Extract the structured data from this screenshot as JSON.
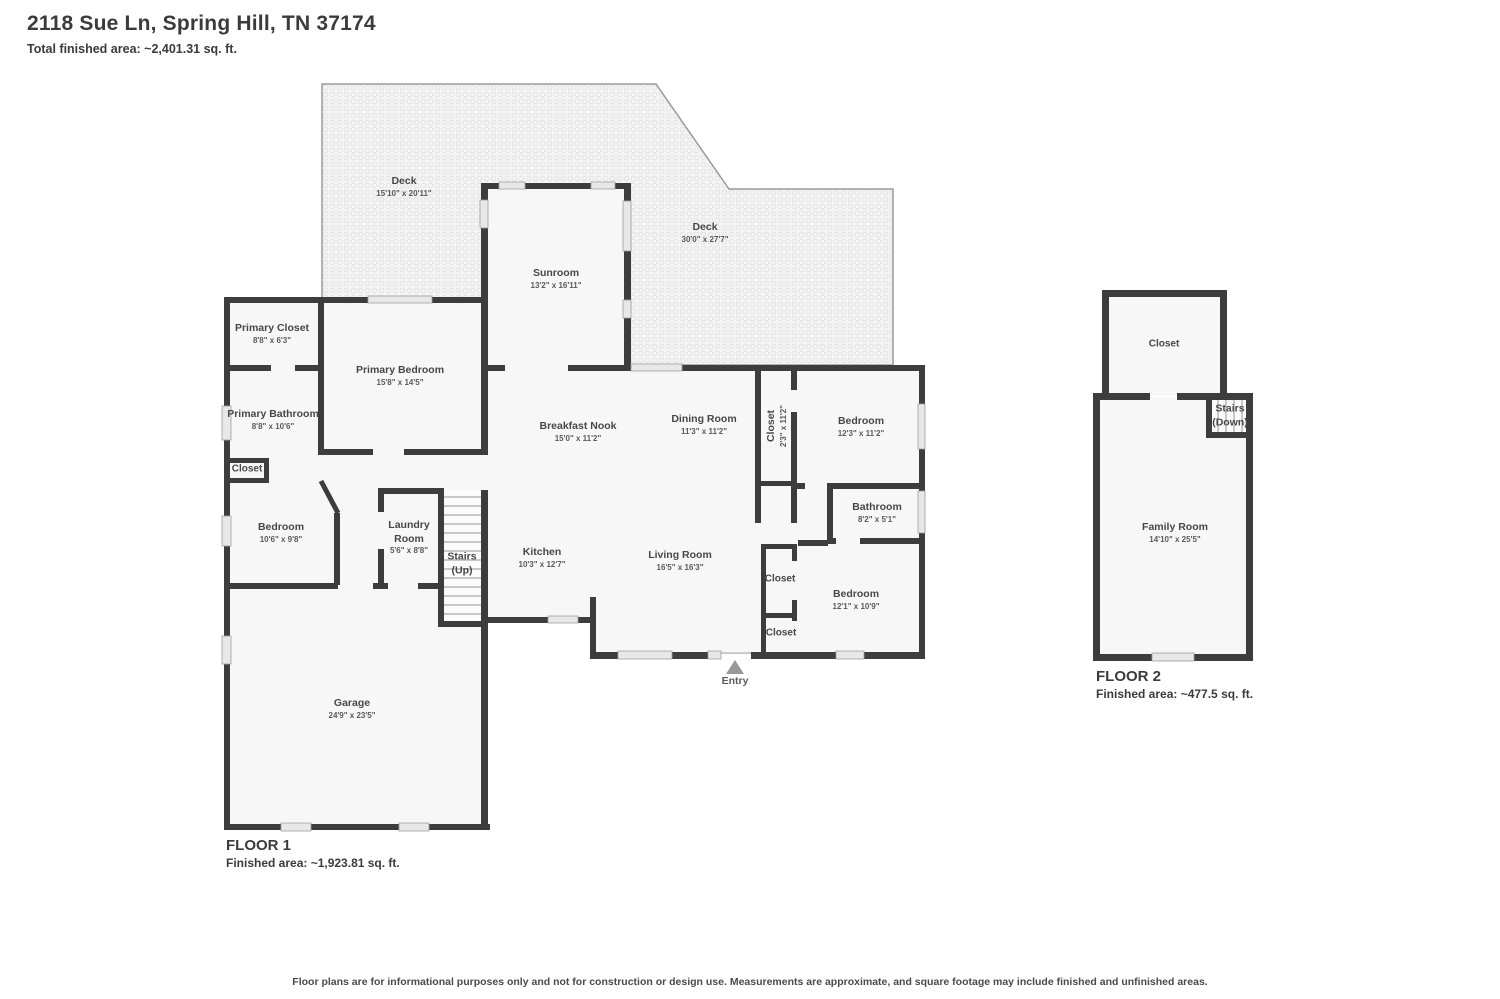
{
  "header": {
    "title": "2118 Sue Ln, Spring Hill, TN 37174",
    "subtitle": "Total finished area: ~2,401.31 sq. ft."
  },
  "floor1": {
    "title": "FLOOR 1",
    "area": "Finished area: ~1,923.81 sq. ft.",
    "rooms": {
      "deck_left": {
        "name": "Deck",
        "dims": "15'10\" x 20'11\""
      },
      "deck_right": {
        "name": "Deck",
        "dims": "30'0\" x 27'7\""
      },
      "sunroom": {
        "name": "Sunroom",
        "dims": "13'2\" x 16'11\""
      },
      "primary_closet": {
        "name": "Primary Closet",
        "dims": "8'8\" x 6'3\""
      },
      "primary_bedroom": {
        "name": "Primary Bedroom",
        "dims": "15'8\" x 14'5\""
      },
      "primary_bathroom": {
        "name": "Primary Bathroom",
        "dims": "8'8\" x 10'6\""
      },
      "closet_a": {
        "name": "Closet"
      },
      "bedroom_left": {
        "name": "Bedroom",
        "dims": "10'6\" x 9'8\""
      },
      "laundry": {
        "name": "Laundry Room",
        "dims": "5'6\" x 8'8\""
      },
      "stairs": {
        "name": "Stairs",
        "dims": "(Up)"
      },
      "kitchen": {
        "name": "Kitchen",
        "dims": "10'3\" x 12'7\""
      },
      "breakfast": {
        "name": "Breakfast Nook",
        "dims": "15'0\" x 11'2\""
      },
      "dining": {
        "name": "Dining Room",
        "dims": "11'3\" x 11'2\""
      },
      "closet_tall": {
        "name": "Closet",
        "dims": "2'3\" x 11'2\""
      },
      "bedroom_ne": {
        "name": "Bedroom",
        "dims": "12'3\" x 11'2\""
      },
      "bathroom": {
        "name": "Bathroom",
        "dims": "8'2\" x 5'1\""
      },
      "living": {
        "name": "Living Room",
        "dims": "16'5\" x 16'3\""
      },
      "closet_b": {
        "name": "Closet"
      },
      "closet_c": {
        "name": "Closet"
      },
      "bedroom_se": {
        "name": "Bedroom",
        "dims": "12'1\" x 10'9\""
      },
      "garage": {
        "name": "Garage",
        "dims": "24'9\" x 23'5\""
      },
      "entry": {
        "name": "Entry"
      }
    }
  },
  "floor2": {
    "title": "FLOOR 2",
    "area": "Finished area: ~477.5 sq. ft.",
    "rooms": {
      "closet": {
        "name": "Closet"
      },
      "stairs": {
        "name": "Stairs",
        "dims": "(Down)"
      },
      "family": {
        "name": "Family Room",
        "dims": "14'10\" x 25'5\""
      }
    }
  },
  "disclaimer": "Floor plans are for informational purposes only and not for construction or design use. Measurements are approximate, and square footage may include finished and unfinished areas.",
  "colors": {
    "wall": "#3d3d3d",
    "room_fill": "#f7f7f7",
    "window": "#e8e8e8",
    "deck_dot": "#e3e3e3"
  }
}
